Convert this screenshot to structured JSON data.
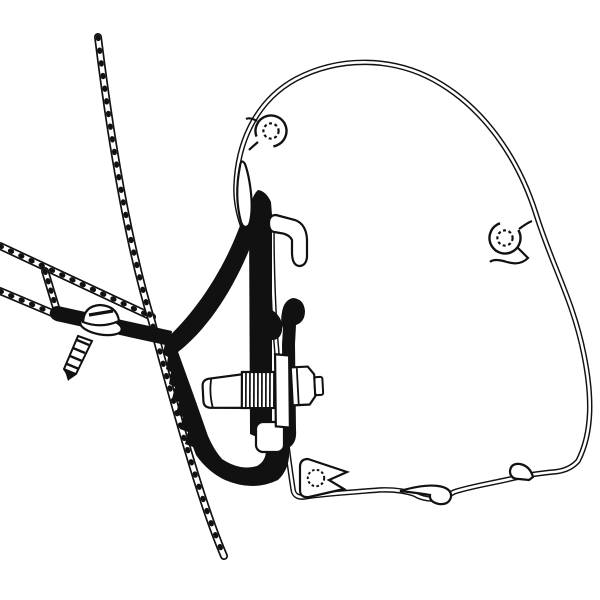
{
  "canvas": {
    "width": 600,
    "height": 600,
    "background": "#ffffff",
    "line_color": "#111111",
    "fill_color": "#ffffff"
  },
  "diagram": {
    "type": "technical-line-drawing",
    "subject": "awning-adapter-bracket-cross-section",
    "components": [
      "van-wall-panel-hatched",
      "van-roof-outer-skin-hatched",
      "van-roof-inner-skin-hatched",
      "roof-rail-connector-hatched",
      "adapter-bracket-solid-black",
      "bracket-foot",
      "bracket-front-arc",
      "bracket-clamp-arm-serrated",
      "bracket-rear-jaw",
      "self-tapping-screw",
      "clamp-bolt-with-hex-nut",
      "awning-case-profile",
      "awning-rail-hook-tab",
      "awning-rail-beak",
      "screw-boss-top",
      "screw-boss-right",
      "screw-boss-bottom-arrow",
      "bottom-curl-hook",
      "bottom-right-hook"
    ]
  }
}
